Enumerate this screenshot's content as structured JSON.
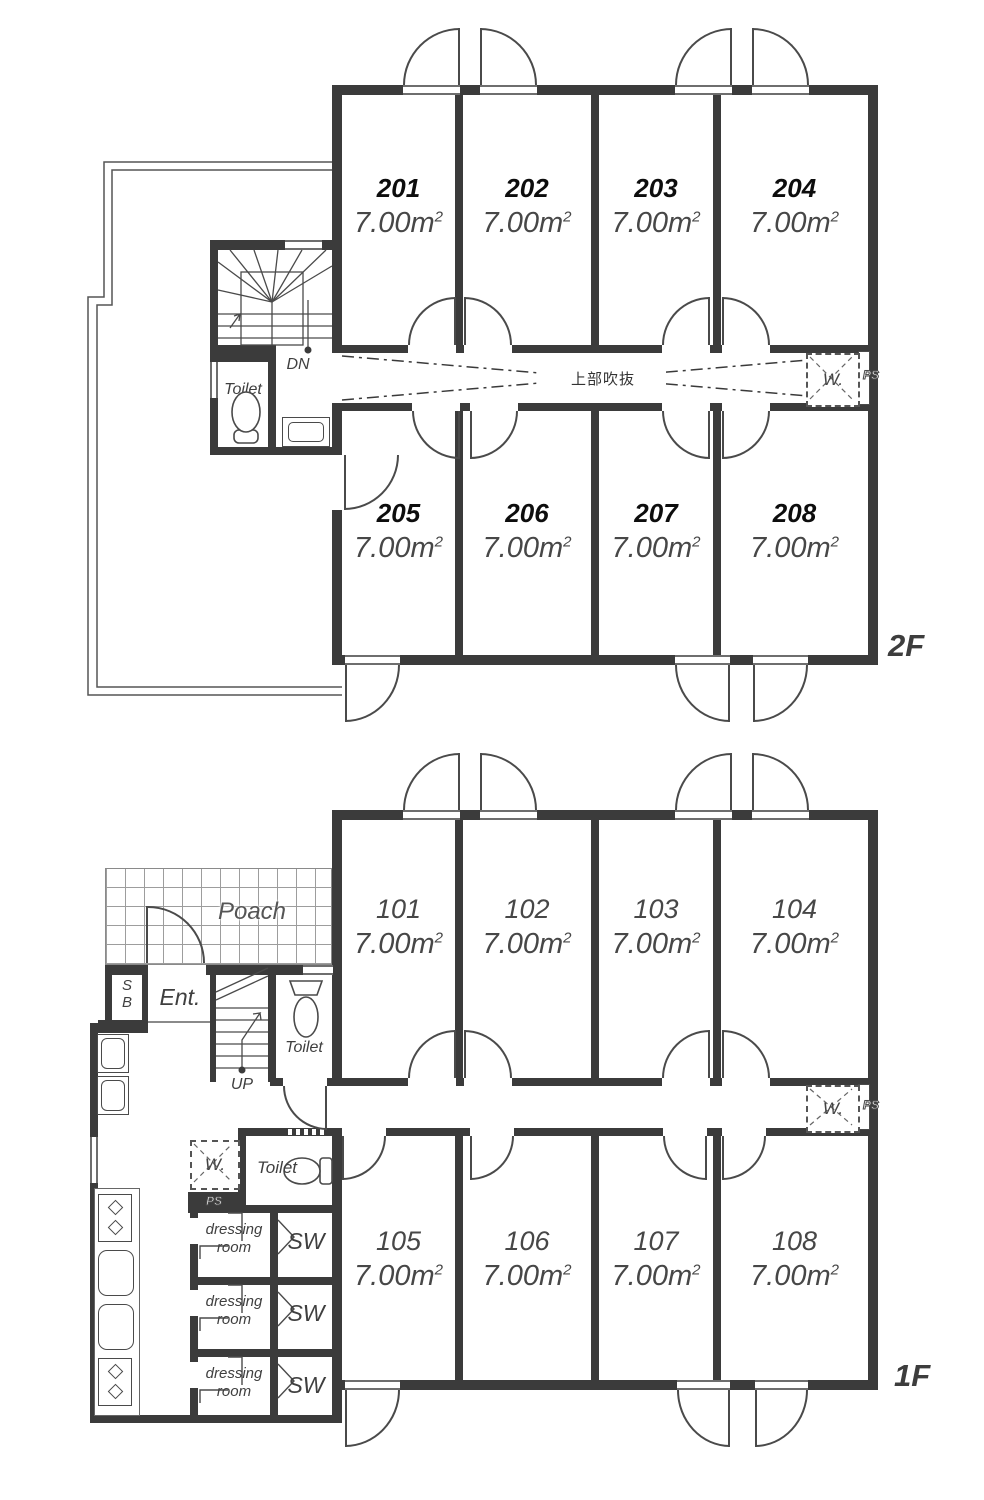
{
  "floor2": {
    "label": "2F",
    "corridor_note": "上部吹抜",
    "rooms_top": [
      {
        "no": "201",
        "area": "7.00m"
      },
      {
        "no": "202",
        "area": "7.00m"
      },
      {
        "no": "203",
        "area": "7.00m"
      },
      {
        "no": "204",
        "area": "7.00m"
      }
    ],
    "rooms_bottom": [
      {
        "no": "205",
        "area": "7.00m"
      },
      {
        "no": "206",
        "area": "7.00m"
      },
      {
        "no": "207",
        "area": "7.00m"
      },
      {
        "no": "208",
        "area": "7.00m"
      }
    ]
  },
  "floor1": {
    "label": "1F",
    "rooms_top": [
      {
        "no": "101",
        "area": "7.00m"
      },
      {
        "no": "102",
        "area": "7.00m"
      },
      {
        "no": "103",
        "area": "7.00m"
      },
      {
        "no": "104",
        "area": "7.00m"
      }
    ],
    "rooms_bottom": [
      {
        "no": "105",
        "area": "7.00m"
      },
      {
        "no": "106",
        "area": "7.00m"
      },
      {
        "no": "107",
        "area": "7.00m"
      },
      {
        "no": "108",
        "area": "7.00m"
      }
    ]
  },
  "labels": {
    "sup2": "2",
    "toilet": "Toilet",
    "dn": "DN",
    "up": "UP",
    "ent": "Ent.",
    "poach": "Poach",
    "sb_top": "S",
    "sb_bottom": "B",
    "dressing_line1": "dressing",
    "dressing_line2": "room",
    "sw": "SW",
    "washer": "W.",
    "ps": "PS"
  },
  "colors": {
    "wall": "#3b3b3b",
    "line": "#4a4a4a",
    "room_number_2f": "#0d0d0d",
    "room_text_gray": "#474747"
  }
}
